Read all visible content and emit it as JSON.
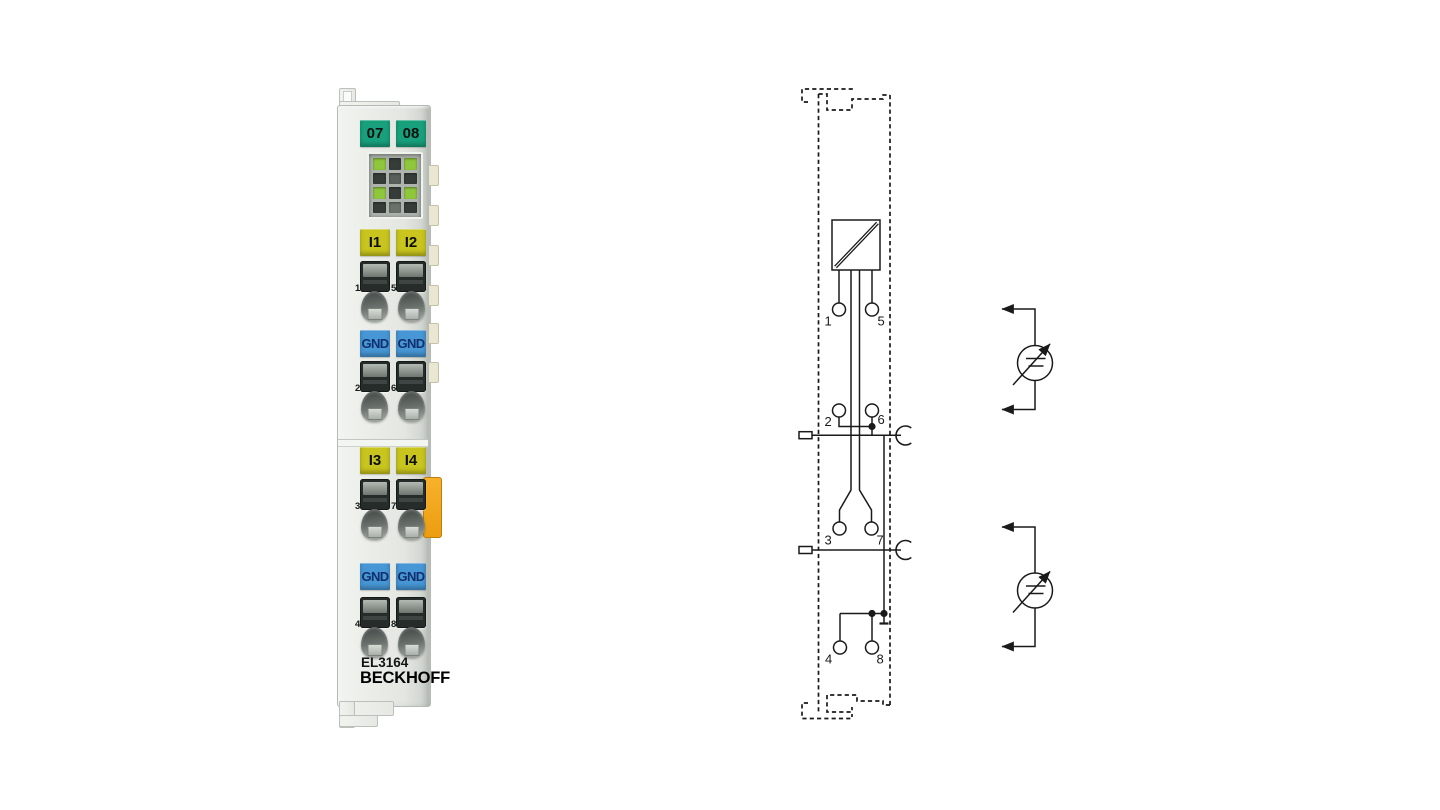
{
  "module": {
    "brand": "BECKHOFF",
    "model": "EL3164",
    "channel_labels_top": [
      "07",
      "08"
    ],
    "input_labels_12": [
      "I1",
      "I2"
    ],
    "gnd_labels_upper": [
      "GND",
      "GND"
    ],
    "input_labels_34": [
      "I3",
      "I4"
    ],
    "gnd_labels_lower": [
      "GND",
      "GND"
    ],
    "contact_numbers": [
      "1",
      "5",
      "2",
      "6",
      "3",
      "7",
      "4",
      "8"
    ],
    "colors": {
      "housing_grey": "#e8eae6",
      "label_green": "#18a07c",
      "label_yellow": "#c9c51e",
      "label_blue": "#4796d5",
      "led_green": "#8fc73c",
      "led_dark": "#3a413d",
      "orange_latch": "#f2a317"
    }
  },
  "diagram": {
    "terminal_numbers": [
      "1",
      "5",
      "2",
      "6",
      "3",
      "7",
      "4",
      "8"
    ],
    "symbols": [
      "adc-converter-box",
      "shield-contact-arc",
      "shield-terminal-rect",
      "junction-dot",
      "ground-tick",
      "adjustable-voltage-source"
    ]
  }
}
